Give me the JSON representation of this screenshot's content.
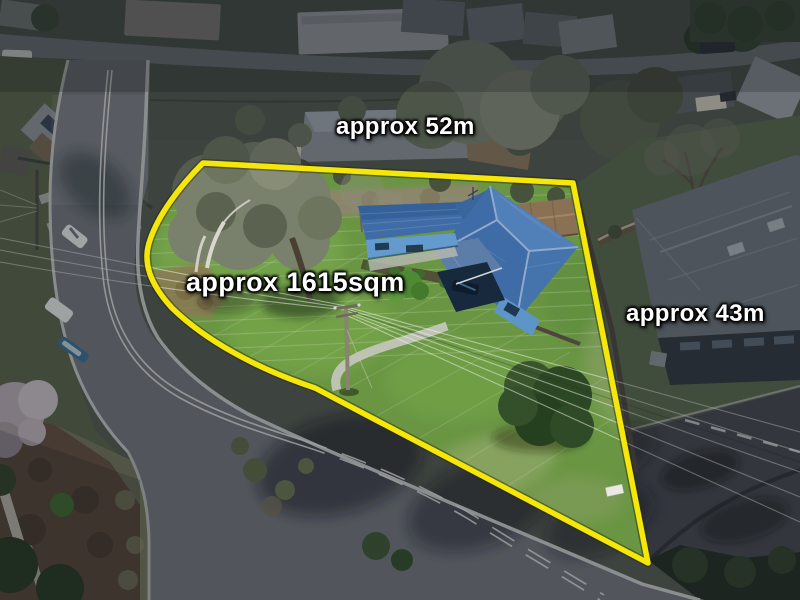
{
  "annotations": {
    "top_width": "approx 52m",
    "area": "approx 1615sqm",
    "right_depth": "approx 43m"
  },
  "colors": {
    "boundary_line": "#F6E70A",
    "annotation_text": "#FFFFFF",
    "annotation_outline": "#000000",
    "house_roof_blue": "#3F6CA6",
    "house_wall_blue": "#649BCE",
    "property_lawn": "#6A9643",
    "road_asphalt": "#75797D",
    "neighbor_roof_grey": "#6E767C",
    "shed_roof_brown": "#8A7154"
  }
}
